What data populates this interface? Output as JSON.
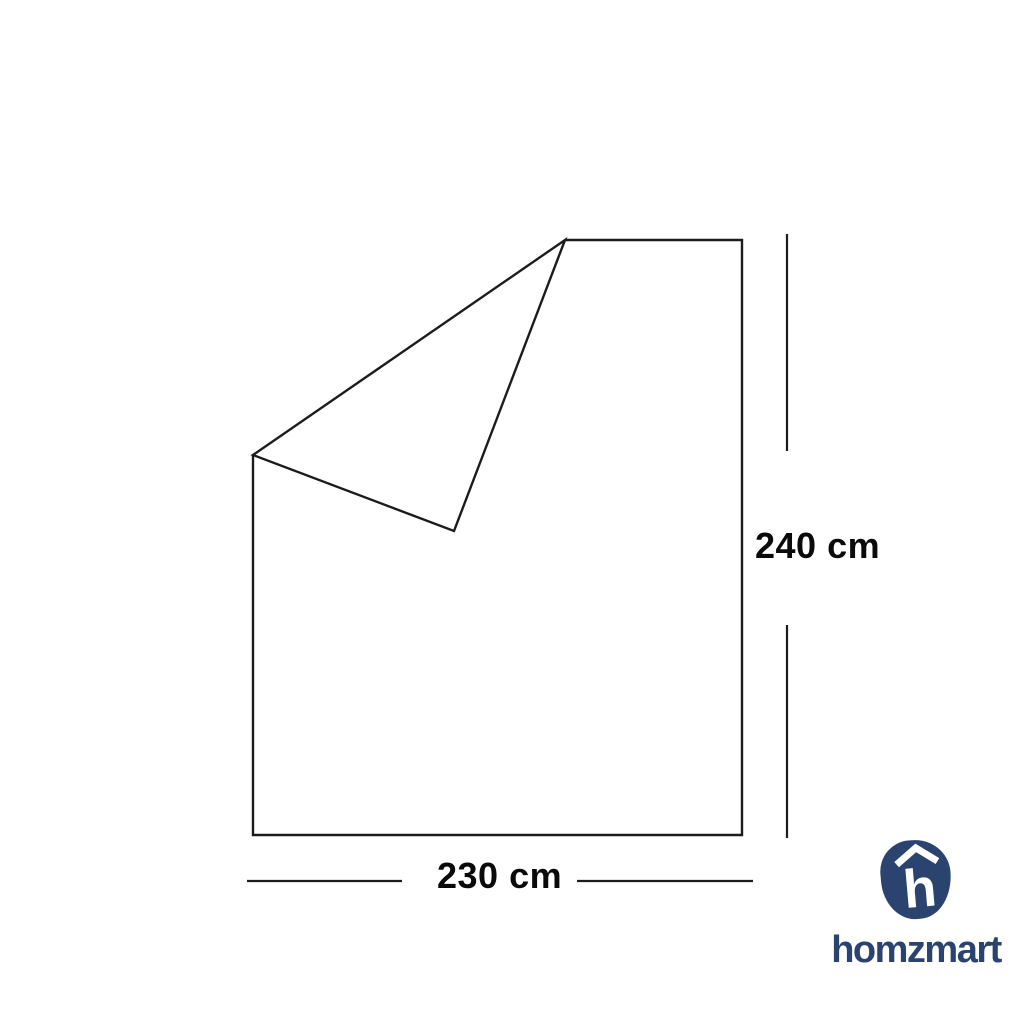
{
  "page": {
    "background_color": "#FFFFFF"
  },
  "diagram": {
    "description": "flat sheet with folded top-left corner",
    "height_label": "240 cm",
    "width_label": "230 cm",
    "line_color": "#1C1C1C",
    "label_color": "#0A0A0A"
  },
  "brand": {
    "wordmark": "homzmart",
    "logo_letter": "h",
    "logo_icon": "homzmart-pebble-h-icon",
    "roof_icon": "roof-chevron-icon",
    "brand_color": "#2B436F"
  }
}
